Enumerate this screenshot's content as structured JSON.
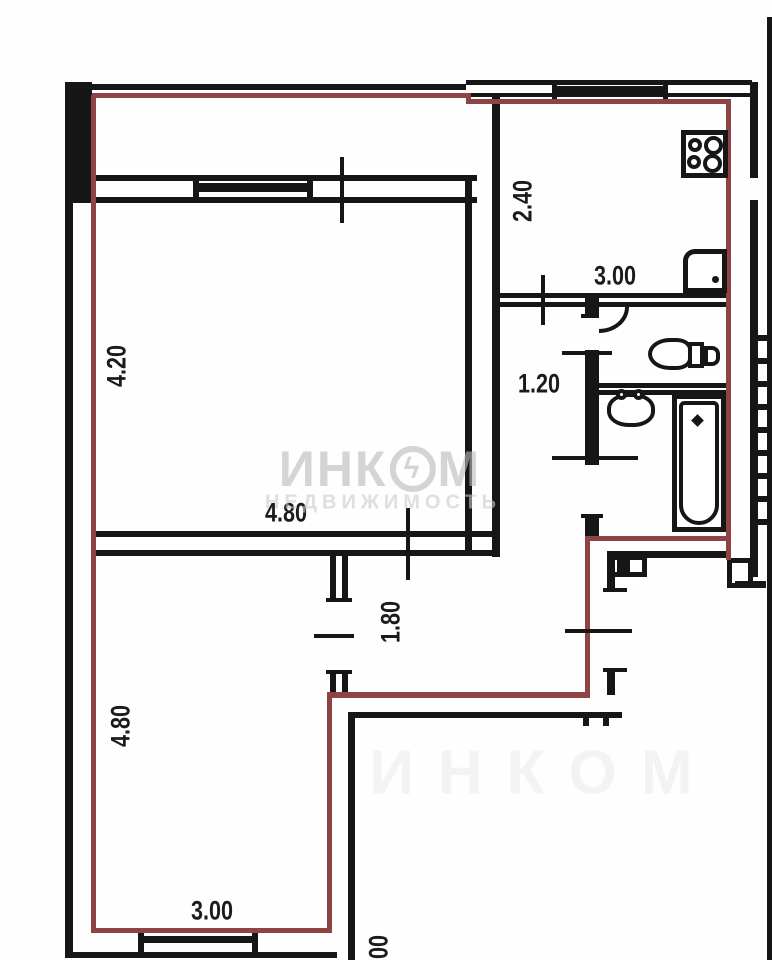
{
  "plan": {
    "type": "apartment-floor-plan",
    "colors": {
      "wall": "#161616",
      "apartment_boundary": "#8e4444",
      "dimension_text": "#1b1b1b",
      "watermark": "#bebebe"
    },
    "dimensions": {
      "room1_height": "4.20",
      "room1_width": "4.80",
      "kitchen_depth": "2.40",
      "kitchen_width": "3.00",
      "hall_width": "1.20",
      "corridor_depth": "1.80",
      "room2_height": "4.80",
      "room2_width": "3.00",
      "edge_partial": "00"
    },
    "watermark": {
      "brand_left": "ИНК",
      "brand_right": "М",
      "logo_symbol": "ϟ",
      "subtitle": "НЕДВИЖИМОСТЬ",
      "ghost": "ИНКОМ"
    }
  }
}
